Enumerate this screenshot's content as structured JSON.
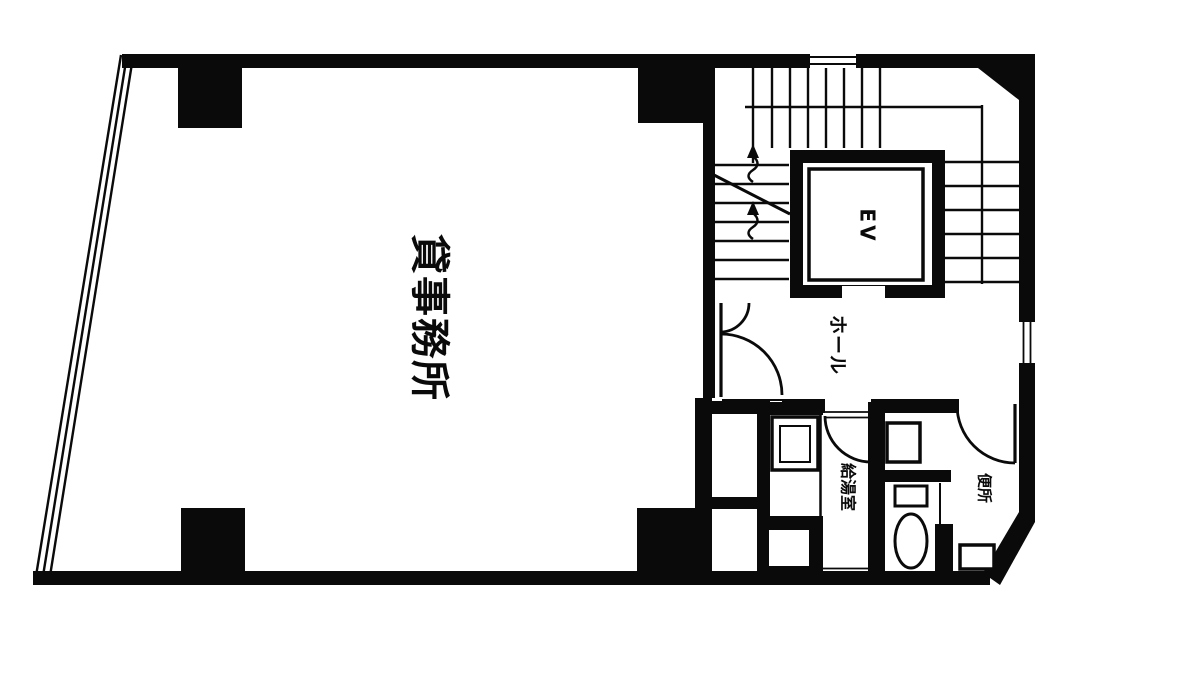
{
  "document": {
    "kind": "scanned architectural floor plan, black ink on white paper",
    "colors": {
      "ink": "#0a0a0a",
      "paper": "#ffffff"
    },
    "rooms": {
      "office": {
        "label": "貸事務所",
        "orientation": "rotated-90"
      },
      "elevator": {
        "label": "EV",
        "orientation": "rotated-90"
      },
      "hall": {
        "label": "ホール",
        "orientation": "rotated-90"
      },
      "kitchenette": {
        "label": "給湯室",
        "orientation": "rotated-90"
      },
      "toilet": {
        "label": "便所",
        "orientation": "rotated-90"
      }
    }
  }
}
